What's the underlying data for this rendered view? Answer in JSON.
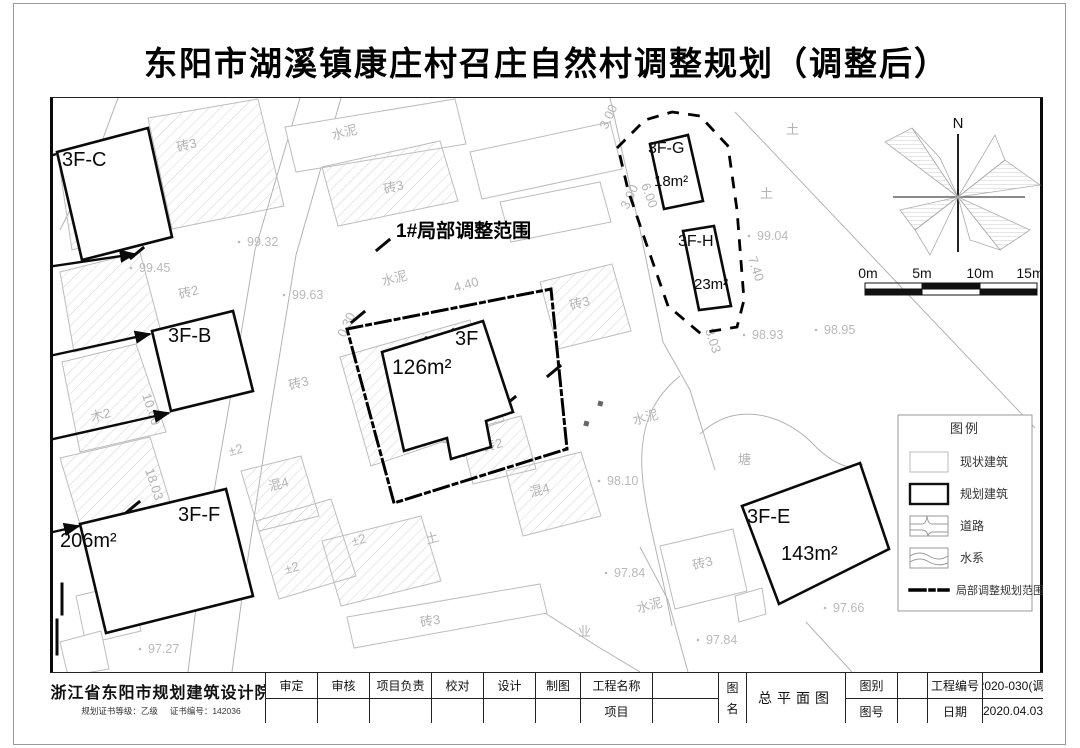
{
  "title": "东阳市湖溪镇康庄村召庄自然村调整规划（调整后）",
  "map": {
    "adjustment_label": "1#局部调整范围",
    "north": "N",
    "scale_ticks": [
      "0m",
      "5m",
      "10m",
      "15m"
    ],
    "buildings": {
      "c": {
        "label": "3F-C"
      },
      "b": {
        "label": "3F-B"
      },
      "f": {
        "label": "3F-F",
        "area": "206m²"
      },
      "g": {
        "label": "3F-G",
        "area": "18m²"
      },
      "h": {
        "label": "3F-H",
        "area": "23m²"
      },
      "e": {
        "label": "3F-E",
        "area": "143m²"
      },
      "main": {
        "label": "3F",
        "area": "126m²"
      }
    },
    "materials": [
      "砖3",
      "砖2",
      "木2",
      "混4",
      "±2",
      "土",
      "水泥",
      "塘",
      "业"
    ],
    "elevations": [
      "99.32",
      "99.45",
      "99.63",
      "99.04",
      "98.93",
      "98.95",
      "98.10",
      "97.84",
      "97.84",
      "97.66",
      "97.27"
    ],
    "dims": [
      "4.88",
      "10.00",
      "18.03",
      "18.00",
      "11.40",
      "11.00",
      "11.00",
      "4.40",
      "0.30",
      "3.00",
      "3.00",
      "6.00",
      "7.40",
      "3.03"
    ]
  },
  "legend": {
    "title": "图例",
    "items": [
      "现状建筑",
      "规划建筑",
      "道路",
      "水系",
      "局部调整规划范围"
    ]
  },
  "titleblock": {
    "institute": "浙江省东阳市规划建筑设计院",
    "cert_grade": "规划证书等级：乙级",
    "cert_no": "证书编号：142036",
    "fields": {
      "shending": "审定",
      "shenhe": "审核",
      "xiangmufuze": "项目负责",
      "jiaodui": "校对",
      "sheji": "设计",
      "zhitu": "制图",
      "gongchengmingcheng": "工程名称",
      "xiangmu": "项目",
      "tu": "图",
      "ming": "名",
      "tuming_value": "总平面图",
      "tubie": "图别",
      "tuhao": "图号",
      "gongchengbianhao": "工程编号",
      "gongchengbianhao_value": "2020-030(调)",
      "riqi": "日期",
      "riqi_value": "2020.04.03"
    }
  }
}
